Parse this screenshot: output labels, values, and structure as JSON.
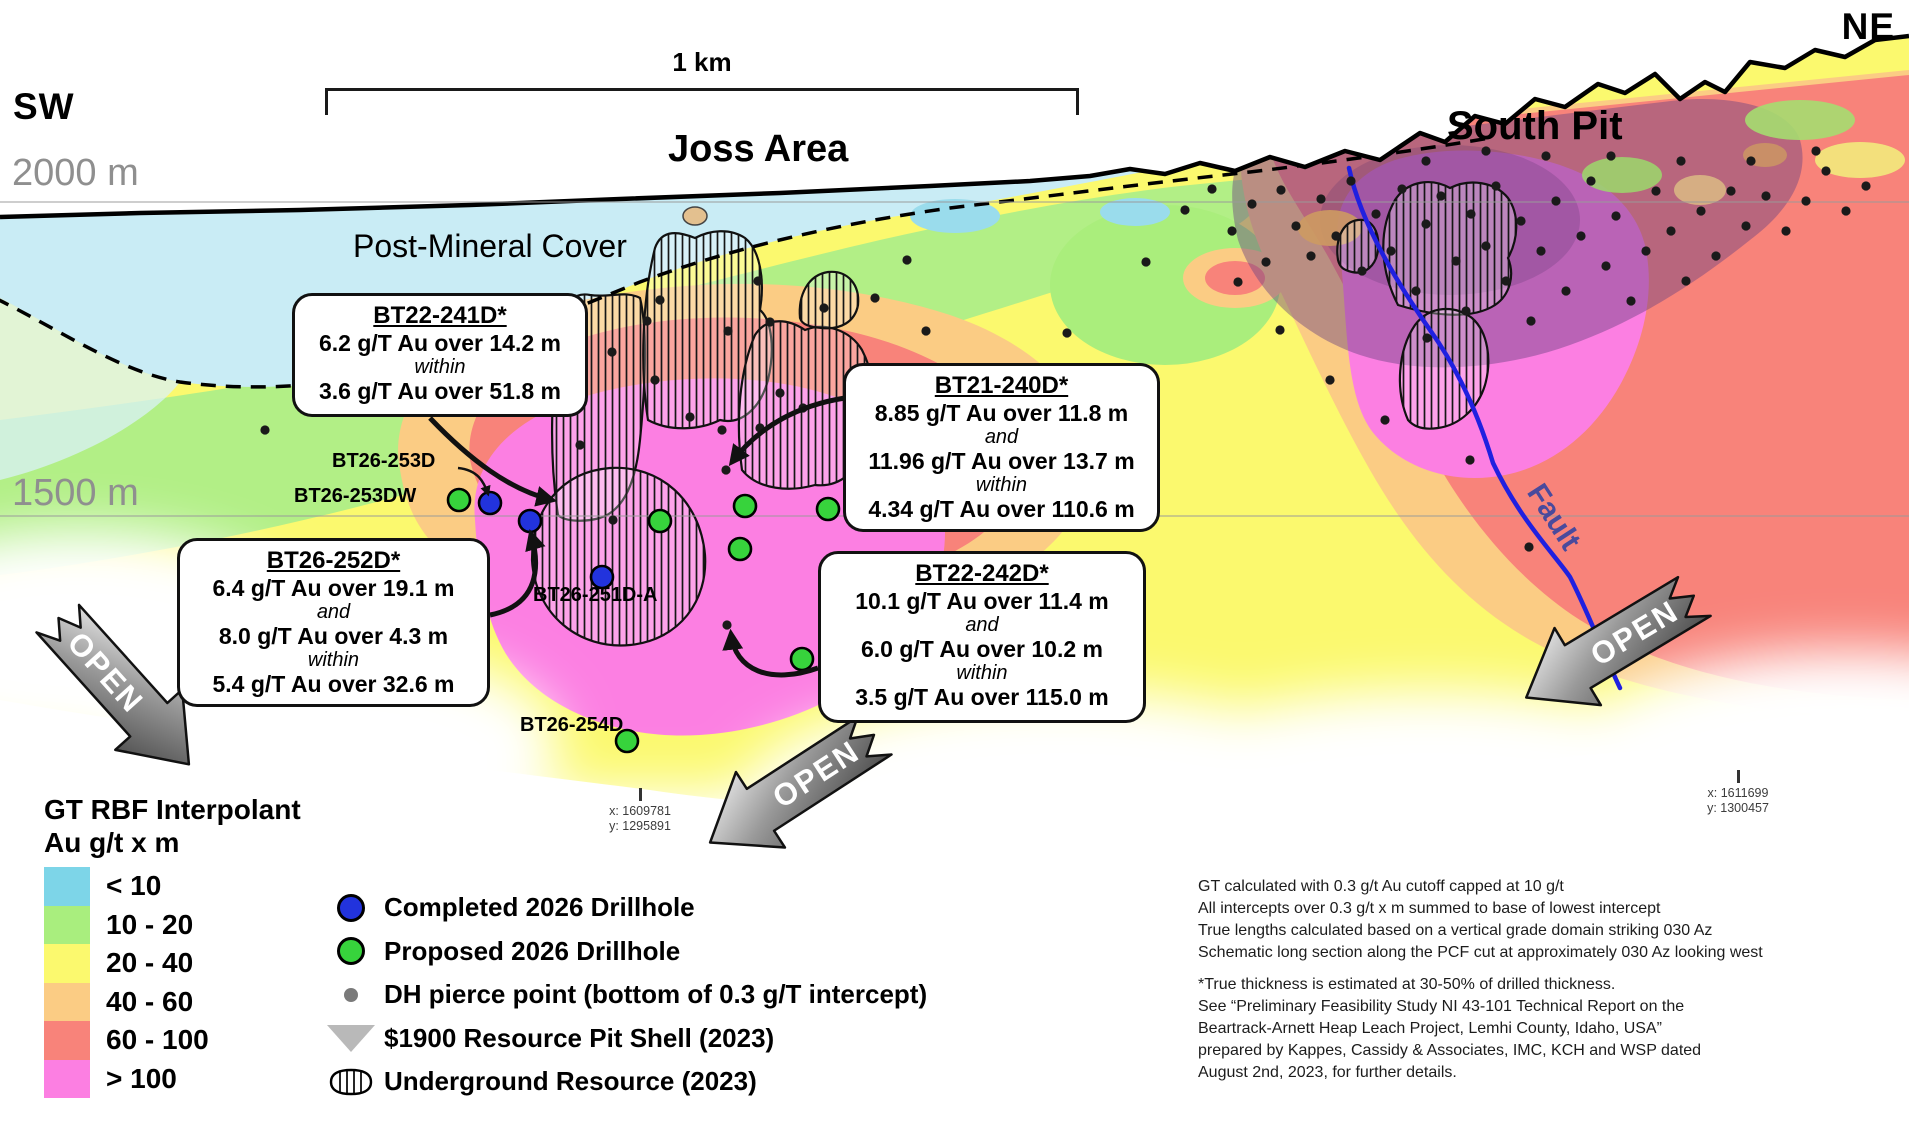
{
  "labels": {
    "sw": "SW",
    "ne": "NE",
    "elev_top": "2000 m",
    "elev_mid": "1500 m",
    "scale": "1 km",
    "joss": "Joss Area",
    "south_pit": "South Pit",
    "cover": "Post-Mineral Cover",
    "fault": "Fault",
    "open": "OPEN"
  },
  "callouts": [
    {
      "title": "BT22-241D*",
      "lines": [
        {
          "t": "6.2 g/T Au over 14.2 m",
          "k": "v"
        },
        {
          "t": "within",
          "k": "c"
        },
        {
          "t": "3.6 g/T Au over 51.8 m",
          "k": "v"
        }
      ]
    },
    {
      "title": "BT21-240D*",
      "lines": [
        {
          "t": "8.85 g/T Au over 11.8 m",
          "k": "v"
        },
        {
          "t": "and",
          "k": "c"
        },
        {
          "t": "11.96 g/T Au over 13.7 m",
          "k": "v"
        },
        {
          "t": "within",
          "k": "c"
        },
        {
          "t": "4.34 g/T Au over 110.6 m",
          "k": "v"
        }
      ]
    },
    {
      "title": "BT26-252D*",
      "lines": [
        {
          "t": "6.4 g/T Au over 19.1 m",
          "k": "v"
        },
        {
          "t": "and",
          "k": "c"
        },
        {
          "t": "8.0 g/T Au over 4.3 m",
          "k": "v"
        },
        {
          "t": "within",
          "k": "c"
        },
        {
          "t": "5.4 g/T Au over 32.6 m",
          "k": "v"
        }
      ]
    },
    {
      "title": "BT22-242D*",
      "lines": [
        {
          "t": "10.1 g/T Au over 11.4 m",
          "k": "v"
        },
        {
          "t": "and",
          "k": "c"
        },
        {
          "t": "6.0 g/T Au over 10.2 m",
          "k": "v"
        },
        {
          "t": "within",
          "k": "c"
        },
        {
          "t": "3.5 g/T Au over 115.0 m",
          "k": "v"
        }
      ]
    }
  ],
  "drill_labels": [
    "BT26-253D",
    "BT26-253DW",
    "BT26-251D-A",
    "BT26-254D"
  ],
  "legend": {
    "title_line1": "GT RBF Interpolant",
    "title_line2": "Au g/t x m",
    "grades": [
      {
        "range": "< 10",
        "color": "#7dd5e8"
      },
      {
        "range": "10 - 20",
        "color": "#a9ee7e"
      },
      {
        "range": "20 - 40",
        "color": "#fbf96e"
      },
      {
        "range": "40 - 60",
        "color": "#fbcc84"
      },
      {
        "range": "60 - 100",
        "color": "#f8837a"
      },
      {
        "range": "> 100",
        "color": "#fc7fe2"
      }
    ],
    "symbols": [
      {
        "icon": "circle-blue",
        "label": "Completed 2026 Drillhole"
      },
      {
        "icon": "circle-green",
        "label": "Proposed 2026 Drillhole"
      },
      {
        "icon": "dot-gray",
        "label": "DH pierce point (bottom of 0.3 g/T intercept)"
      },
      {
        "icon": "pit-shell-triangle",
        "label": "$1900 Resource Pit Shell (2023)"
      },
      {
        "icon": "underground-hatch",
        "label": "Underground Resource (2023)"
      }
    ]
  },
  "notes": {
    "para1": [
      "GT calculated with 0.3 g/t Au cutoff capped at 10 g/t",
      "All intercepts over 0.3 g/t x m summed to base of lowest intercept",
      "True lengths calculated based on a vertical grade domain striking 030 Az",
      "Schematic long section along the PCF cut at approximately 030 Az looking west"
    ],
    "para2": [
      "*True thickness is estimated at 30-50% of drilled thickness.",
      "See “Preliminary Feasibility Study NI 43-101 Technical Report on the",
      "Beartrack-Arnett Heap Leach Project, Lemhi County, Idaho, USA”",
      "prepared by Kappes, Cassidy & Associates, IMC, KCH and WSP dated",
      "August 2nd, 2023, for further details."
    ]
  },
  "coordinates": [
    {
      "x": "x: 1609781",
      "y": "y: 1295891"
    },
    {
      "x": "x: 1611699",
      "y": "y: 1300457"
    }
  ],
  "map_points": {
    "completed": [
      [
        490,
        503
      ],
      [
        530,
        521
      ],
      [
        602,
        577
      ]
    ],
    "proposed": [
      [
        459,
        500
      ],
      [
        660,
        521
      ],
      [
        745,
        506
      ],
      [
        828,
        509
      ],
      [
        740,
        549
      ],
      [
        802,
        659
      ],
      [
        627,
        741
      ]
    ],
    "pierce": [
      [
        265,
        430
      ],
      [
        520,
        352
      ],
      [
        647,
        321
      ],
      [
        690,
        417
      ],
      [
        728,
        331
      ],
      [
        758,
        281
      ],
      [
        803,
        408
      ],
      [
        824,
        308
      ],
      [
        875,
        298
      ],
      [
        770,
        322
      ],
      [
        780,
        393
      ],
      [
        722,
        430
      ],
      [
        907,
        260
      ],
      [
        926,
        331
      ],
      [
        1067,
        333
      ],
      [
        1146,
        262
      ],
      [
        1238,
        282
      ],
      [
        580,
        445
      ],
      [
        612,
        352
      ],
      [
        660,
        300
      ],
      [
        760,
        428
      ],
      [
        726,
        470
      ],
      [
        727,
        625
      ],
      [
        882,
        560
      ],
      [
        655,
        380
      ],
      [
        613,
        520
      ],
      [
        1330,
        380
      ],
      [
        1385,
        420
      ],
      [
        1470,
        460
      ],
      [
        1529,
        547
      ],
      [
        1427,
        338
      ],
      [
        1280,
        330
      ],
      [
        1185,
        210
      ],
      [
        1212,
        189
      ],
      [
        1232,
        231
      ],
      [
        1252,
        204
      ],
      [
        1266,
        262
      ],
      [
        1281,
        190
      ],
      [
        1296,
        226
      ],
      [
        1311,
        256
      ],
      [
        1321,
        199
      ],
      [
        1336,
        236
      ],
      [
        1351,
        181
      ],
      [
        1362,
        271
      ],
      [
        1376,
        214
      ],
      [
        1391,
        251
      ],
      [
        1402,
        189
      ],
      [
        1416,
        291
      ],
      [
        1426,
        224
      ],
      [
        1441,
        196
      ],
      [
        1456,
        261
      ],
      [
        1466,
        311
      ],
      [
        1471,
        214
      ],
      [
        1486,
        246
      ],
      [
        1496,
        186
      ],
      [
        1506,
        281
      ],
      [
        1521,
        221
      ],
      [
        1531,
        321
      ],
      [
        1541,
        251
      ],
      [
        1556,
        201
      ],
      [
        1566,
        291
      ],
      [
        1581,
        236
      ],
      [
        1591,
        181
      ],
      [
        1606,
        266
      ],
      [
        1616,
        216
      ],
      [
        1631,
        301
      ],
      [
        1646,
        251
      ],
      [
        1656,
        191
      ],
      [
        1671,
        231
      ],
      [
        1686,
        281
      ],
      [
        1701,
        211
      ],
      [
        1716,
        256
      ],
      [
        1731,
        191
      ],
      [
        1746,
        226
      ],
      [
        1766,
        196
      ],
      [
        1786,
        231
      ],
      [
        1806,
        201
      ],
      [
        1826,
        171
      ],
      [
        1846,
        211
      ],
      [
        1866,
        186
      ],
      [
        1816,
        151
      ],
      [
        1751,
        161
      ],
      [
        1681,
        161
      ],
      [
        1611,
        156
      ],
      [
        1546,
        156
      ],
      [
        1486,
        151
      ],
      [
        1426,
        161
      ]
    ]
  },
  "colors": {
    "completed_hole": "#2233dd",
    "proposed_hole": "#37d33c",
    "fault_line": "#2020e0"
  }
}
